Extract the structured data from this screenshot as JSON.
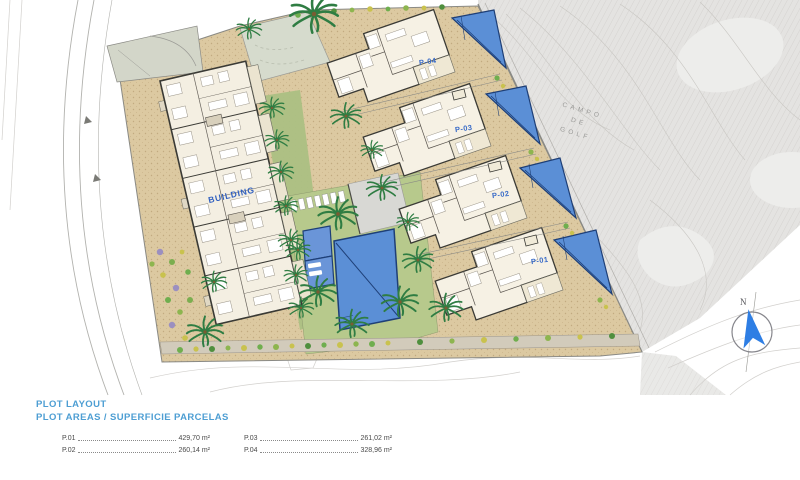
{
  "legend": {
    "title": "PLOT LAYOUT",
    "subtitle": "PLOT AREAS / SUPERFICIE PARCELAS",
    "entries": [
      {
        "label": "P.01",
        "value": "429,70 m²"
      },
      {
        "label": "P.02",
        "value": "260,14 m²"
      },
      {
        "label": "P.03",
        "value": "261,02 m²"
      },
      {
        "label": "P.04",
        "value": "328,96 m²"
      }
    ]
  },
  "plan": {
    "building_label": "BUILDING",
    "plot_labels": [
      "P-01",
      "P-02",
      "P-03",
      "P-04"
    ],
    "golf_area_lines": [
      "CAMPO",
      "DE",
      "GOLF"
    ],
    "compass_north": "N"
  },
  "colors": {
    "legend_blue": "#4d9ed3",
    "plot_label_blue": "#3a6cc8",
    "pool_blue": "#5b8fd6",
    "pool_outline": "#1e3f77",
    "sand_paving": "#dcc9a1",
    "lawn_green": "#b7c98c",
    "golf_grey": "#e4e3e1",
    "compass_blue": "#2e7ee4"
  }
}
